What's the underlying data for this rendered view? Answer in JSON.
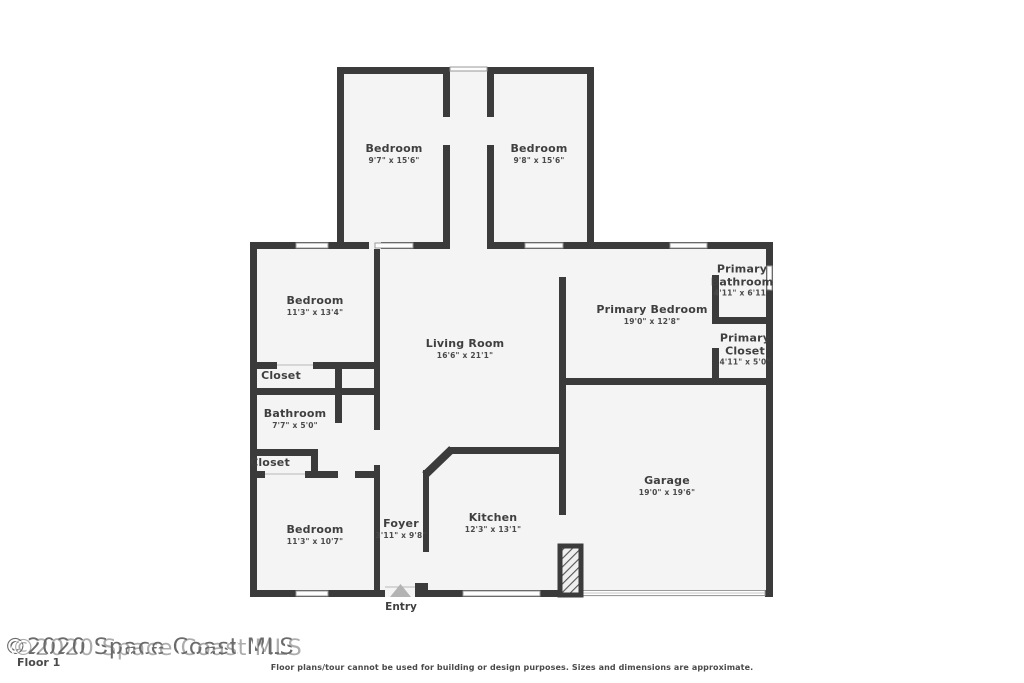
{
  "floor_label": "Floor 1",
  "watermark": "©2020 Space Coast MLS",
  "entry_label": "Entry",
  "disclaimer": "Floor plans/tour cannot be used for building or design purposes. Sizes and dimensions are approximate.",
  "rooms": [
    {
      "name": "Bedroom",
      "dims": "9'7\" x 15'6\""
    },
    {
      "name": "Bedroom",
      "dims": "9'8\" x 15'6\""
    },
    {
      "name": "Bedroom",
      "dims": "11'3\" x 13'4\""
    },
    {
      "name": "Living Room",
      "dims": "16'6\" x 21'1\""
    },
    {
      "name": "Primary Bedroom",
      "dims": "19'0\" x 12'8\""
    },
    {
      "name": "Primary Bathroom",
      "dims": "4'11\" x 6'11\""
    },
    {
      "name": "Primary Closet",
      "dims": "4'11\" x 5'0\""
    },
    {
      "name": "Closet",
      "dims": ""
    },
    {
      "name": "Bathroom",
      "dims": "7'7\" x 5'0\""
    },
    {
      "name": "Closet",
      "dims": ""
    },
    {
      "name": "Bedroom",
      "dims": "11'3\" x 10'7\""
    },
    {
      "name": "Foyer",
      "dims": "3'11\" x 9'8\""
    },
    {
      "name": "Kitchen",
      "dims": "12'3\" x 13'1\""
    },
    {
      "name": "Garage",
      "dims": "19'0\" x 19'6\""
    }
  ],
  "colors": {
    "wall": "#3b3b3b",
    "floor": "#f4f4f4",
    "window_frame": "#999999",
    "text": "#3f3f3f",
    "entry_arrow": "#b3b3b3"
  }
}
